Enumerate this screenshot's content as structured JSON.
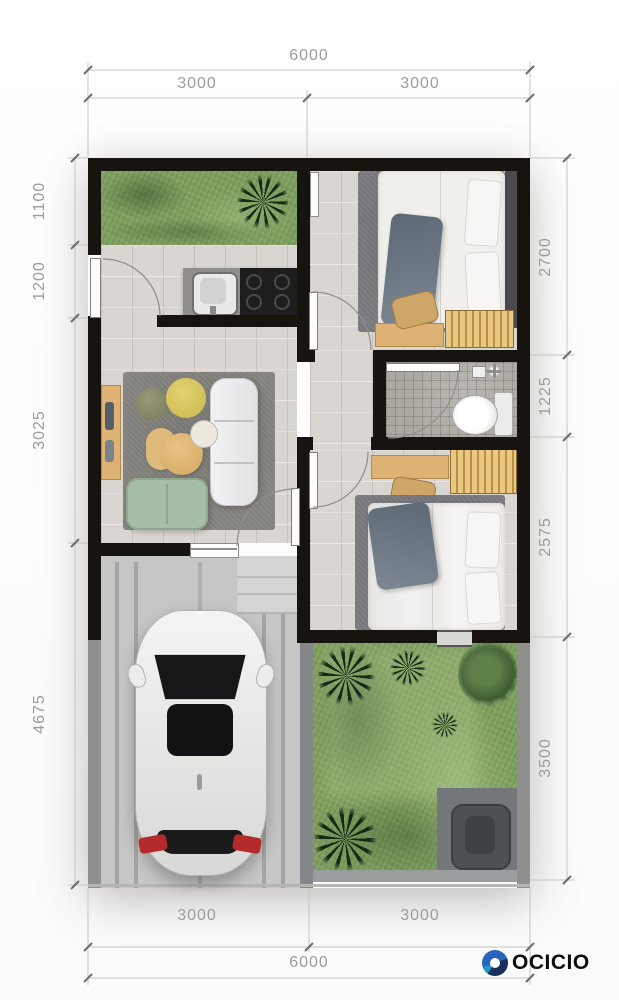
{
  "document": {
    "type": "house-floor-plan"
  },
  "dimensions": {
    "top": {
      "total": "6000",
      "segments": [
        "3000",
        "3000"
      ]
    },
    "bottom": {
      "total": "6000",
      "segments": [
        "3000",
        "3000"
      ]
    },
    "left": [
      "1100",
      "1200",
      "3025",
      "4675"
    ],
    "right": [
      "2700",
      "1225",
      "2575",
      "3500"
    ]
  },
  "brand": {
    "name": "OCICIO"
  },
  "colors": {
    "wall": "#17130f",
    "tile": "#d9d5d0",
    "grass": "#7fa05f",
    "wood": "#ddb273",
    "sofa_green": "#a6bda7",
    "logo_blue": "#2a63c0",
    "dimension_text": "#9c9c9c"
  }
}
